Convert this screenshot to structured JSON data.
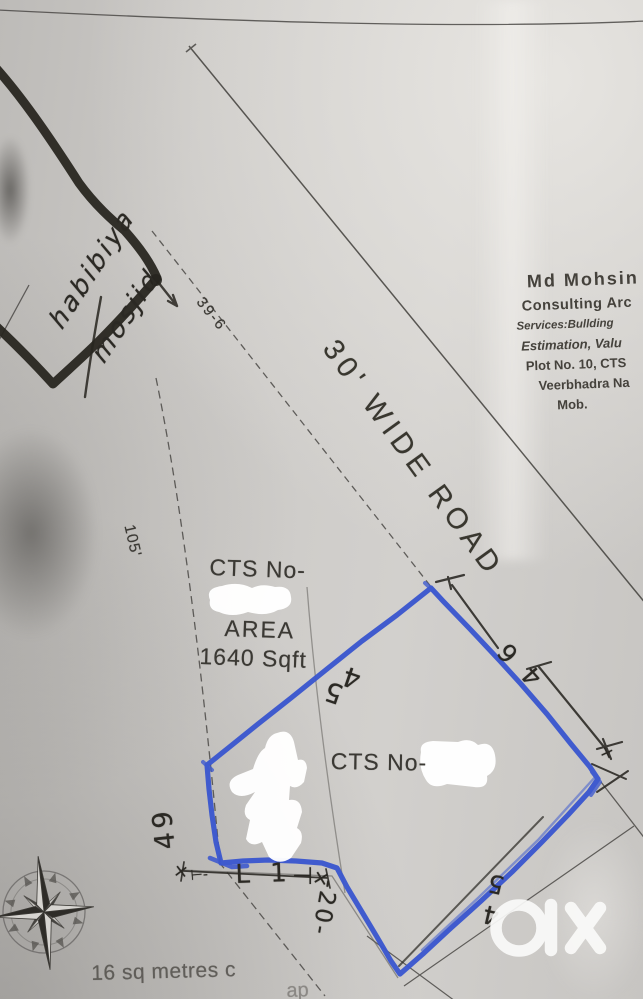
{
  "plan": {
    "mosque": {
      "line1": "habibiya",
      "line2": "mosjid"
    },
    "road_label": "30' WIDE ROAD",
    "dims": {
      "frontage": "39-6",
      "west_len": "105'",
      "top_left_edge": {
        "c1": "4",
        "c2": "5"
      },
      "top_right_edge": {
        "c1": "6",
        "c2": "4"
      },
      "left_edge": "49",
      "bottom_right_edge": {
        "c1": "5",
        "c2": "4"
      },
      "bottom_left_edge": "-20-",
      "bottom_edge_marks": {
        "x_left": "×",
        "lead": "⊢-",
        "seg": "L 1",
        "end": "⊣",
        "x_mid": "×",
        "x_right": "×"
      }
    },
    "plot1": {
      "cts_label": "CTS No-",
      "area_label": "AREA",
      "area_value": "1640 Sqft"
    },
    "plot2": {
      "cts_label": "CTS No-"
    },
    "footer_note": {
      "visible": "16 sq metres c",
      "trailing": "ap"
    },
    "attribution": {
      "line1": "Md Mohsin",
      "line2": "Consulting Arc",
      "line3": "Services:Bullding",
      "line4": "Estimation, Valu",
      "line5": "Plot No. 10, CTS",
      "line6": "Veerbhadra Na",
      "line7": "Mob."
    }
  },
  "icons": {
    "compass": "compass-rose",
    "watermark": "olx-logo"
  },
  "colors": {
    "pen_blue": "#3b57cf",
    "marker_black": "#27251f",
    "printed_grey": "#4b4946",
    "paper": "#c8c6c3",
    "redaction_white": "#ffffff",
    "watermark_white": "#fafaf9"
  }
}
